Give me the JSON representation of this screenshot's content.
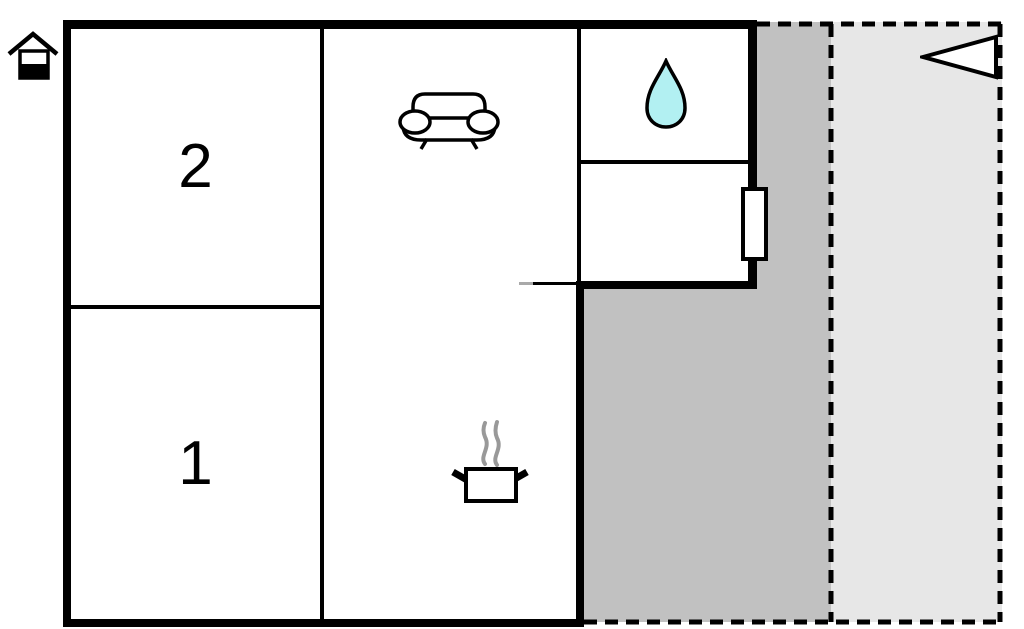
{
  "floorplan": {
    "rooms": [
      {
        "id": "room-top-left",
        "label": "2"
      },
      {
        "id": "room-bottom-left",
        "label": "1"
      }
    ],
    "icons": [
      "house-icon",
      "north-arrow-icon",
      "sofa-icon",
      "water-drop-icon",
      "cooking-pot-icon",
      "steam-icon"
    ],
    "colors": {
      "wall": "#000000",
      "terrace": "#c1c1c1",
      "patio": "#e7e7e7",
      "water_drop": "#b2f0f2",
      "steam": "#999999",
      "background": "#ffffff",
      "label": "#000000"
    }
  }
}
